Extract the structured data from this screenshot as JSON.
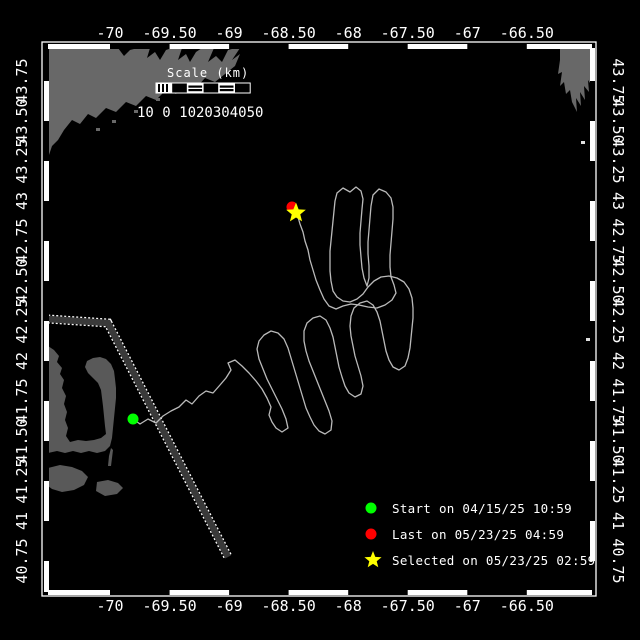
{
  "colors": {
    "background": "#000000",
    "land": "#686868",
    "cape": "#595959",
    "track": "#bababa",
    "lane_fill": "#3a3a3a",
    "lane_edge": "#ffffff",
    "frame": "#ffffff",
    "text": "#ffffff",
    "start": "#00ff00",
    "last": "#ff0000",
    "selected": "#ffff00"
  },
  "axes": {
    "lon_labels": [
      "-70",
      "-69.50",
      "-69",
      "-68.50",
      "-68",
      "-67.50",
      "-67",
      "-66.50"
    ],
    "lat_labels": [
      "43.75",
      "43.50",
      "43.25",
      "43",
      "42.75",
      "42.50",
      "42.25",
      "42",
      "41.75",
      "41.50",
      "41.25",
      "41",
      "40.75"
    ]
  },
  "scale_bar": {
    "title": "Scale (km)",
    "values": "10 0 1020304050",
    "pattern": [
      "hatch",
      "black",
      "band",
      "black",
      "band",
      "black"
    ]
  },
  "legend": {
    "items": [
      {
        "marker": "dot",
        "color": "#00ff00",
        "label": "Start on 04/15/25 10:59"
      },
      {
        "marker": "dot",
        "color": "#ff0000",
        "label": "Last on 05/23/25 04:59"
      },
      {
        "marker": "star",
        "color": "#ffff00",
        "label": "Selected on 05/23/25 02:59"
      }
    ]
  },
  "markers": {
    "start": {
      "x": 133,
      "y": 419
    },
    "last": {
      "x": 292,
      "y": 207
    },
    "selected": {
      "x": 296,
      "y": 213
    }
  },
  "shipping_lane": [
    [
      48,
      319
    ],
    [
      108,
      323
    ],
    [
      228,
      557
    ]
  ],
  "track_points": [
    [
      133,
      419
    ],
    [
      140,
      424
    ],
    [
      148,
      419
    ],
    [
      156,
      423
    ],
    [
      163,
      416
    ],
    [
      171,
      411
    ],
    [
      179,
      407
    ],
    [
      186,
      400
    ],
    [
      192,
      404
    ],
    [
      199,
      396
    ],
    [
      206,
      391
    ],
    [
      213,
      393
    ],
    [
      220,
      385
    ],
    [
      226,
      378
    ],
    [
      231,
      370
    ],
    [
      228,
      363
    ],
    [
      235,
      360
    ],
    [
      242,
      366
    ],
    [
      249,
      373
    ],
    [
      256,
      381
    ],
    [
      262,
      389
    ],
    [
      267,
      398
    ],
    [
      271,
      407
    ],
    [
      269,
      415
    ],
    [
      272,
      422
    ],
    [
      276,
      428
    ],
    [
      282,
      432
    ],
    [
      288,
      428
    ],
    [
      286,
      419
    ],
    [
      282,
      409
    ],
    [
      277,
      399
    ],
    [
      272,
      389
    ],
    [
      267,
      379
    ],
    [
      263,
      369
    ],
    [
      259,
      359
    ],
    [
      257,
      349
    ],
    [
      259,
      341
    ],
    [
      264,
      335
    ],
    [
      271,
      331
    ],
    [
      278,
      333
    ],
    [
      284,
      339
    ],
    [
      288,
      348
    ],
    [
      291,
      358
    ],
    [
      294,
      368
    ],
    [
      297,
      378
    ],
    [
      300,
      388
    ],
    [
      303,
      398
    ],
    [
      306,
      408
    ],
    [
      310,
      417
    ],
    [
      314,
      425
    ],
    [
      319,
      431
    ],
    [
      325,
      434
    ],
    [
      331,
      430
    ],
    [
      332,
      421
    ],
    [
      329,
      411
    ],
    [
      325,
      401
    ],
    [
      321,
      391
    ],
    [
      317,
      381
    ],
    [
      313,
      371
    ],
    [
      309,
      361
    ],
    [
      306,
      351
    ],
    [
      304,
      341
    ],
    [
      304,
      331
    ],
    [
      307,
      323
    ],
    [
      313,
      318
    ],
    [
      320,
      316
    ],
    [
      326,
      320
    ],
    [
      330,
      328
    ],
    [
      333,
      337
    ],
    [
      335,
      347
    ],
    [
      337,
      357
    ],
    [
      339,
      367
    ],
    [
      342,
      377
    ],
    [
      345,
      386
    ],
    [
      349,
      393
    ],
    [
      355,
      397
    ],
    [
      361,
      394
    ],
    [
      363,
      386
    ],
    [
      361,
      376
    ],
    [
      358,
      366
    ],
    [
      355,
      356
    ],
    [
      353,
      346
    ],
    [
      351,
      336
    ],
    [
      350,
      326
    ],
    [
      351,
      316
    ],
    [
      354,
      308
    ],
    [
      360,
      303
    ],
    [
      367,
      301
    ],
    [
      373,
      305
    ],
    [
      377,
      312
    ],
    [
      380,
      321
    ],
    [
      382,
      331
    ],
    [
      384,
      341
    ],
    [
      386,
      351
    ],
    [
      389,
      360
    ],
    [
      393,
      367
    ],
    [
      399,
      370
    ],
    [
      405,
      366
    ],
    [
      408,
      358
    ],
    [
      410,
      348
    ],
    [
      411,
      338
    ],
    [
      412,
      328
    ],
    [
      413,
      318
    ],
    [
      413,
      308
    ],
    [
      412,
      298
    ],
    [
      409,
      289
    ],
    [
      404,
      282
    ],
    [
      397,
      278
    ],
    [
      389,
      276
    ],
    [
      381,
      277
    ],
    [
      374,
      281
    ],
    [
      368,
      287
    ],
    [
      363,
      294
    ],
    [
      357,
      299
    ],
    [
      350,
      302
    ],
    [
      343,
      301
    ],
    [
      337,
      297
    ],
    [
      333,
      291
    ],
    [
      331,
      281
    ],
    [
      330,
      271
    ],
    [
      330,
      261
    ],
    [
      330,
      251
    ],
    [
      331,
      241
    ],
    [
      332,
      231
    ],
    [
      333,
      221
    ],
    [
      334,
      211
    ],
    [
      335,
      201
    ],
    [
      337,
      193
    ],
    [
      343,
      188
    ],
    [
      350,
      192
    ],
    [
      356,
      187
    ],
    [
      361,
      191
    ],
    [
      363,
      199
    ],
    [
      362,
      209
    ],
    [
      361,
      221
    ],
    [
      360,
      233
    ],
    [
      360,
      245
    ],
    [
      361,
      257
    ],
    [
      362,
      268
    ],
    [
      364,
      278
    ],
    [
      367,
      286
    ],
    [
      369,
      278
    ],
    [
      369,
      266
    ],
    [
      368,
      254
    ],
    [
      368,
      242
    ],
    [
      369,
      230
    ],
    [
      370,
      218
    ],
    [
      371,
      206
    ],
    [
      373,
      195
    ],
    [
      379,
      189
    ],
    [
      386,
      192
    ],
    [
      391,
      198
    ],
    [
      393,
      207
    ],
    [
      393,
      219
    ],
    [
      392,
      231
    ],
    [
      391,
      243
    ],
    [
      390,
      255
    ],
    [
      390,
      267
    ],
    [
      391,
      277
    ],
    [
      394,
      285
    ],
    [
      396,
      293
    ],
    [
      392,
      300
    ],
    [
      385,
      305
    ],
    [
      377,
      308
    ],
    [
      368,
      307
    ],
    [
      359,
      305
    ],
    [
      351,
      304
    ],
    [
      343,
      306
    ],
    [
      336,
      309
    ],
    [
      329,
      306
    ],
    [
      324,
      299
    ],
    [
      320,
      290
    ],
    [
      316,
      280
    ],
    [
      313,
      270
    ],
    [
      310,
      260
    ],
    [
      308,
      250
    ],
    [
      305,
      241
    ],
    [
      303,
      232
    ],
    [
      300,
      224
    ],
    [
      298,
      217
    ],
    [
      296,
      213
    ]
  ],
  "land": {
    "maine": [
      [
        48,
        48
      ],
      [
        118,
        48
      ],
      [
        124,
        56
      ],
      [
        130,
        50
      ],
      [
        138,
        48
      ],
      [
        150,
        48
      ],
      [
        147,
        58
      ],
      [
        155,
        52
      ],
      [
        160,
        60
      ],
      [
        166,
        50
      ],
      [
        172,
        48
      ],
      [
        182,
        48
      ],
      [
        178,
        60
      ],
      [
        186,
        54
      ],
      [
        190,
        62
      ],
      [
        196,
        52
      ],
      [
        202,
        48
      ],
      [
        214,
        48
      ],
      [
        208,
        62
      ],
      [
        216,
        56
      ],
      [
        222,
        62
      ],
      [
        228,
        50
      ],
      [
        236,
        48
      ],
      [
        240,
        48
      ],
      [
        232,
        60
      ],
      [
        240,
        54
      ],
      [
        235,
        66
      ],
      [
        225,
        74
      ],
      [
        215,
        82
      ],
      [
        205,
        78
      ],
      [
        196,
        88
      ],
      [
        186,
        84
      ],
      [
        176,
        94
      ],
      [
        166,
        90
      ],
      [
        156,
        100
      ],
      [
        146,
        96
      ],
      [
        136,
        106
      ],
      [
        126,
        102
      ],
      [
        116,
        112
      ],
      [
        106,
        108
      ],
      [
        96,
        118
      ],
      [
        88,
        114
      ],
      [
        80,
        124
      ],
      [
        72,
        120
      ],
      [
        64,
        130
      ],
      [
        58,
        140
      ],
      [
        52,
        146
      ],
      [
        48,
        158
      ]
    ],
    "nova_scotia": [
      [
        560,
        48
      ],
      [
        592,
        48
      ],
      [
        592,
        86
      ],
      [
        588,
        80
      ],
      [
        589,
        92
      ],
      [
        584,
        86
      ],
      [
        585,
        100
      ],
      [
        580,
        92
      ],
      [
        581,
        106
      ],
      [
        576,
        98
      ],
      [
        577,
        112
      ],
      [
        572,
        102
      ],
      [
        570,
        90
      ],
      [
        566,
        94
      ],
      [
        564,
        82
      ],
      [
        560,
        86
      ],
      [
        562,
        72
      ],
      [
        558,
        74
      ],
      [
        560,
        60
      ]
    ],
    "cape": [
      [
        48,
        346
      ],
      [
        54,
        350
      ],
      [
        59,
        356
      ],
      [
        57,
        362
      ],
      [
        62,
        368
      ],
      [
        60,
        374
      ],
      [
        64,
        380
      ],
      [
        62,
        388
      ],
      [
        66,
        396
      ],
      [
        64,
        404
      ],
      [
        67,
        412
      ],
      [
        65,
        420
      ],
      [
        68,
        428
      ],
      [
        66,
        436
      ],
      [
        70,
        442
      ],
      [
        78,
        440
      ],
      [
        86,
        441
      ],
      [
        94,
        440
      ],
      [
        101,
        438
      ],
      [
        106,
        434
      ],
      [
        105,
        426
      ],
      [
        104,
        416
      ],
      [
        103,
        406
      ],
      [
        102,
        398
      ],
      [
        101,
        390
      ],
      [
        98,
        383
      ],
      [
        93,
        378
      ],
      [
        88,
        373
      ],
      [
        85,
        367
      ],
      [
        87,
        361
      ],
      [
        93,
        358
      ],
      [
        100,
        357
      ],
      [
        106,
        359
      ],
      [
        111,
        364
      ],
      [
        114,
        371
      ],
      [
        115,
        379
      ],
      [
        116,
        388
      ],
      [
        116,
        398
      ],
      [
        115,
        408
      ],
      [
        114,
        418
      ],
      [
        113,
        428
      ],
      [
        112,
        438
      ],
      [
        110,
        446
      ],
      [
        105,
        451
      ],
      [
        97,
        453
      ],
      [
        89,
        451
      ],
      [
        81,
        453
      ],
      [
        73,
        451
      ],
      [
        65,
        453
      ],
      [
        57,
        451
      ],
      [
        48,
        453
      ]
    ],
    "marthas_vineyard": [
      [
        48,
        468
      ],
      [
        60,
        465
      ],
      [
        72,
        467
      ],
      [
        82,
        471
      ],
      [
        88,
        477
      ],
      [
        84,
        485
      ],
      [
        74,
        490
      ],
      [
        62,
        492
      ],
      [
        52,
        489
      ],
      [
        48,
        486
      ]
    ],
    "nantucket": [
      [
        97,
        482
      ],
      [
        108,
        480
      ],
      [
        118,
        483
      ],
      [
        123,
        488
      ],
      [
        117,
        494
      ],
      [
        105,
        496
      ],
      [
        96,
        491
      ]
    ],
    "monomoy": [
      [
        111,
        448
      ],
      [
        113,
        450
      ],
      [
        112,
        458
      ],
      [
        111,
        466
      ],
      [
        108,
        466
      ],
      [
        109,
        456
      ]
    ],
    "specks": [
      {
        "x": 96,
        "y": 128,
        "c": "land"
      },
      {
        "x": 112,
        "y": 120,
        "c": "land"
      },
      {
        "x": 134,
        "y": 110,
        "c": "land"
      },
      {
        "x": 156,
        "y": 98,
        "c": "land"
      },
      {
        "x": 581,
        "y": 141,
        "c": "white"
      },
      {
        "x": 586,
        "y": 338,
        "c": "white"
      }
    ]
  }
}
